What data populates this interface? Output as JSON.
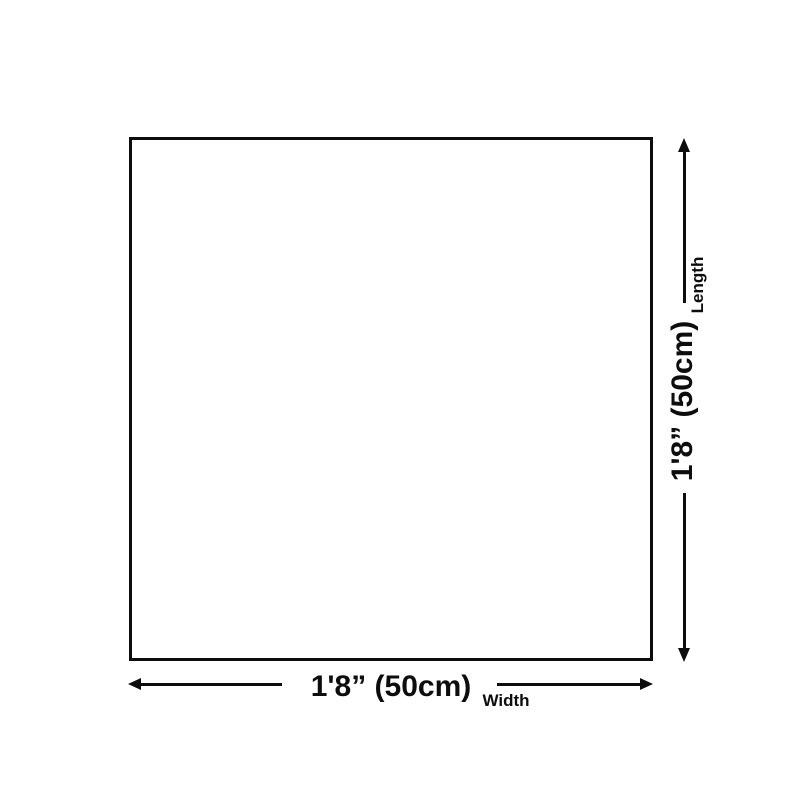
{
  "colors": {
    "background": "#ffffff",
    "line": "#0d0d0d",
    "text": "#0d0d0d"
  },
  "diagram": {
    "shape": "square",
    "dimensions": {
      "length": {
        "value": "1'8” (50cm)",
        "label": "Length"
      },
      "width": {
        "value": "1'8” (50cm)",
        "label": "Width"
      }
    }
  }
}
